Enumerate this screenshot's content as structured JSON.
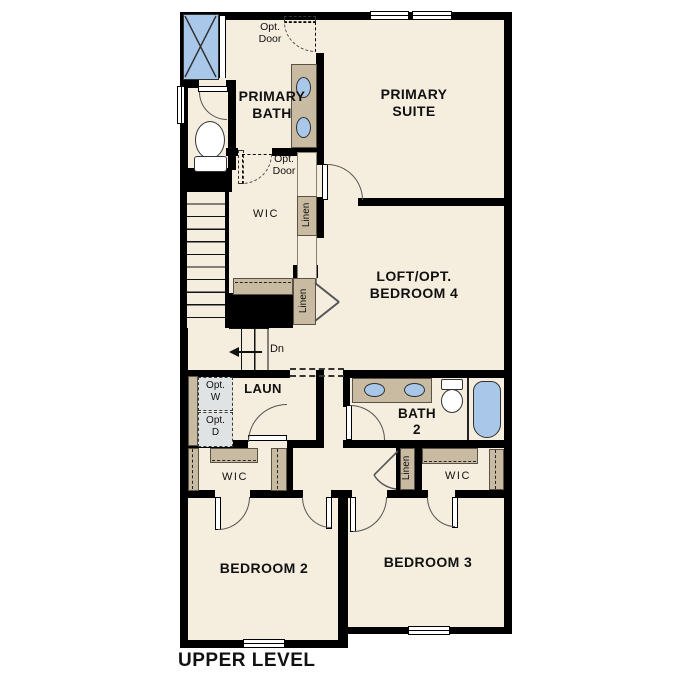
{
  "title": "UPPER LEVEL",
  "rooms": {
    "primary_bath": "PRIMARY\nBATH",
    "primary_suite": "PRIMARY\nSUITE",
    "loft": "LOFT/OPT.\nBEDROOM 4",
    "laundry": "LAUN",
    "bath2": "BATH\n2",
    "bedroom2": "BEDROOM 2",
    "bedroom3": "BEDROOM 3",
    "wic_primary": "WIC",
    "wic_bedroom2": "WIC",
    "wic_bedroom3": "WIC"
  },
  "annotations": {
    "opt_door_top": "Opt.\nDoor",
    "opt_door_wic": "Opt.\nDoor",
    "linen_hall_upper": "Linen",
    "linen_loft": "Linen",
    "linen_bed3": "Linen",
    "opt_washer": "Opt.\nW",
    "opt_dryer": "Opt.\nD",
    "stairs_down": "Dn"
  },
  "colors": {
    "floor": "#f5edde",
    "wall": "#000000",
    "cabinet_tan": "#c8bba1",
    "fixture_blue": "#a9c8e9",
    "appliance_gray": "#e0e3e4"
  }
}
